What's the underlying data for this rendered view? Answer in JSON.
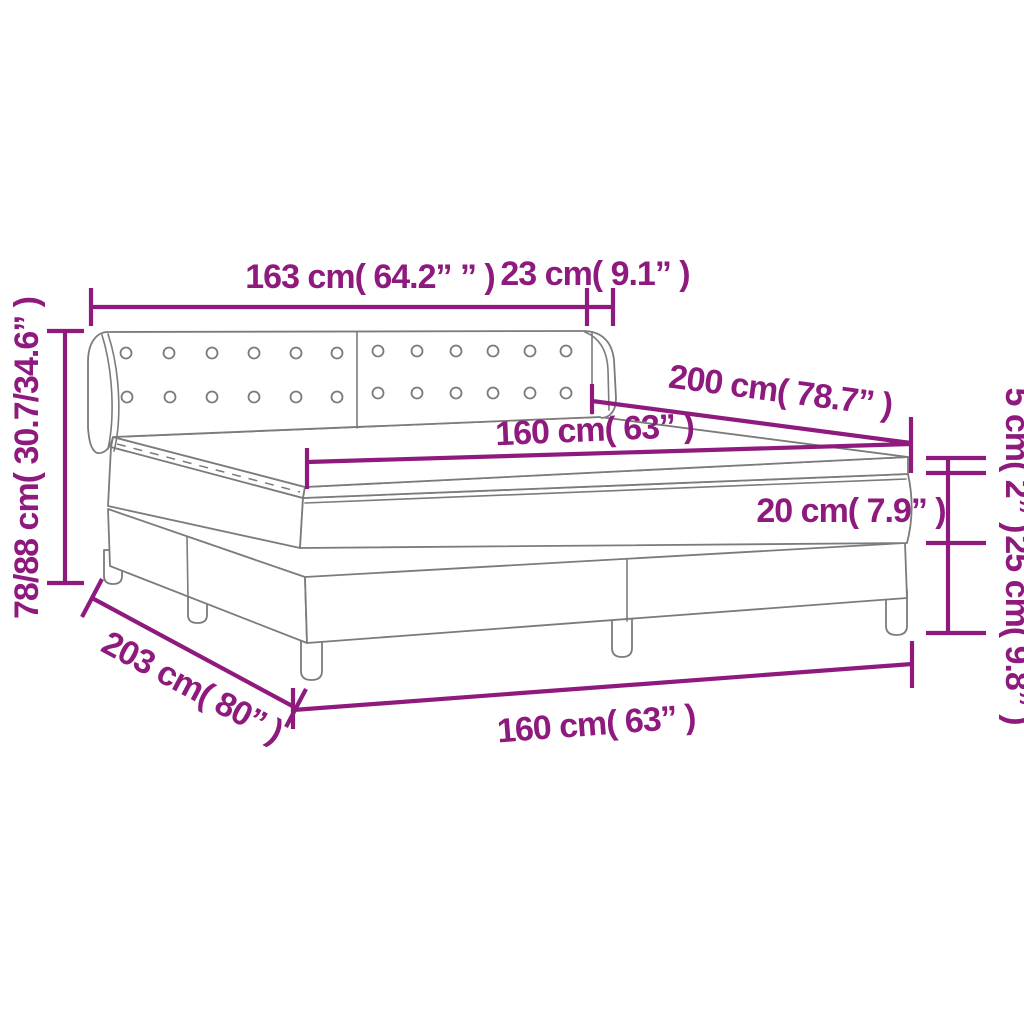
{
  "diagram": {
    "type": "product-dimension-diagram",
    "product": "box-spring-bed-with-tufted-headboard",
    "accent_color": "#8E1A7E",
    "line_color": "#7B7B7B",
    "background_color": "#FFFFFF",
    "labels": {
      "headboard_width": "163 cm( 64.2” ” )",
      "wing_depth": "23 cm( 9.1” )",
      "bed_length": "200 cm( 78.7” )",
      "mattress_width": "160 cm( 63” )",
      "topper_height": "5 cm( 2” )",
      "mattress_height": "20 cm( 7.9” )",
      "base_height": "25 cm( 9.8” )",
      "total_height": "78/88 cm( 30.7/34.6” )",
      "base_length": "203 cm( 80” )",
      "base_width": "160 cm( 63” )"
    }
  }
}
